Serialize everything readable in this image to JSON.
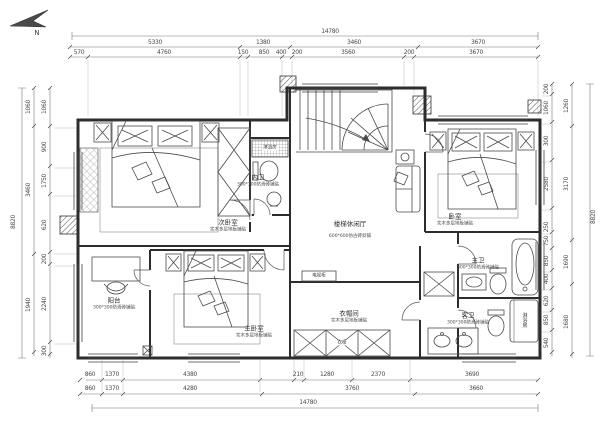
{
  "compass": {
    "label": "N"
  },
  "dims": {
    "top": {
      "total": "14780",
      "row2": [
        "5330",
        "1380",
        "3460",
        "3670"
      ],
      "row3": [
        "570",
        "4760",
        "150",
        "850",
        "400",
        "200",
        "3560",
        "200",
        "3670"
      ]
    },
    "bottom": {
      "total": "14780",
      "row1": [
        "860",
        "1370",
        "4380",
        "210",
        "1280",
        "2370",
        "3690"
      ],
      "row2": [
        "860",
        "1370",
        "4280",
        "3760",
        "3660"
      ]
    },
    "left": {
      "total": "8820",
      "mid": [
        "1060",
        "3460",
        "1940"
      ],
      "inner": [
        "1060",
        "900",
        "1750",
        "620",
        "200",
        "2240",
        "300"
      ]
    },
    "right": {
      "total": "8820",
      "mid": [
        "1260",
        "3170",
        "1690",
        "1680"
      ],
      "inner": [
        "200",
        "1060",
        "300",
        "2580",
        "250",
        "750",
        "850",
        "400",
        "620",
        "850",
        "540"
      ]
    }
  },
  "rooms": {
    "bedroom_top_left": {
      "name": "次卧室",
      "floor": "实木多层地板铺贴"
    },
    "bedroom_top_right": {
      "name": "卧室",
      "floor": "实木多层地板铺贴"
    },
    "master_bedroom": {
      "name": "主卧室",
      "floor": "实木多层地板铺贴"
    },
    "cloakroom": {
      "name": "衣帽间",
      "floor": "实木多层地板铺贴"
    },
    "stair_hall": {
      "name": "楼梯休闲厅",
      "floor": "600*600仿古砖斜铺"
    },
    "inner_bath": {
      "name": "内卫",
      "floor": "300*300防滑砖铺贴"
    },
    "master_bath": {
      "name": "主卫",
      "floor": "300*300防滑砖铺贴"
    },
    "guest_bath": {
      "name": "客卫",
      "floor": "300*300防滑砖铺贴"
    },
    "balcony": {
      "name": "阳台",
      "floor": "300*300防滑砖铺贴"
    },
    "shower_top": {
      "name": "淋浴房"
    },
    "shower_right": {
      "name": "淋浴房"
    },
    "wardrobe": {
      "name": "衣柜"
    },
    "tv_cabinet": {
      "name": "电视柜"
    }
  },
  "colors": {
    "line": "#3a3a3a",
    "dim": "#5a5a5a",
    "background": "#ffffff"
  }
}
